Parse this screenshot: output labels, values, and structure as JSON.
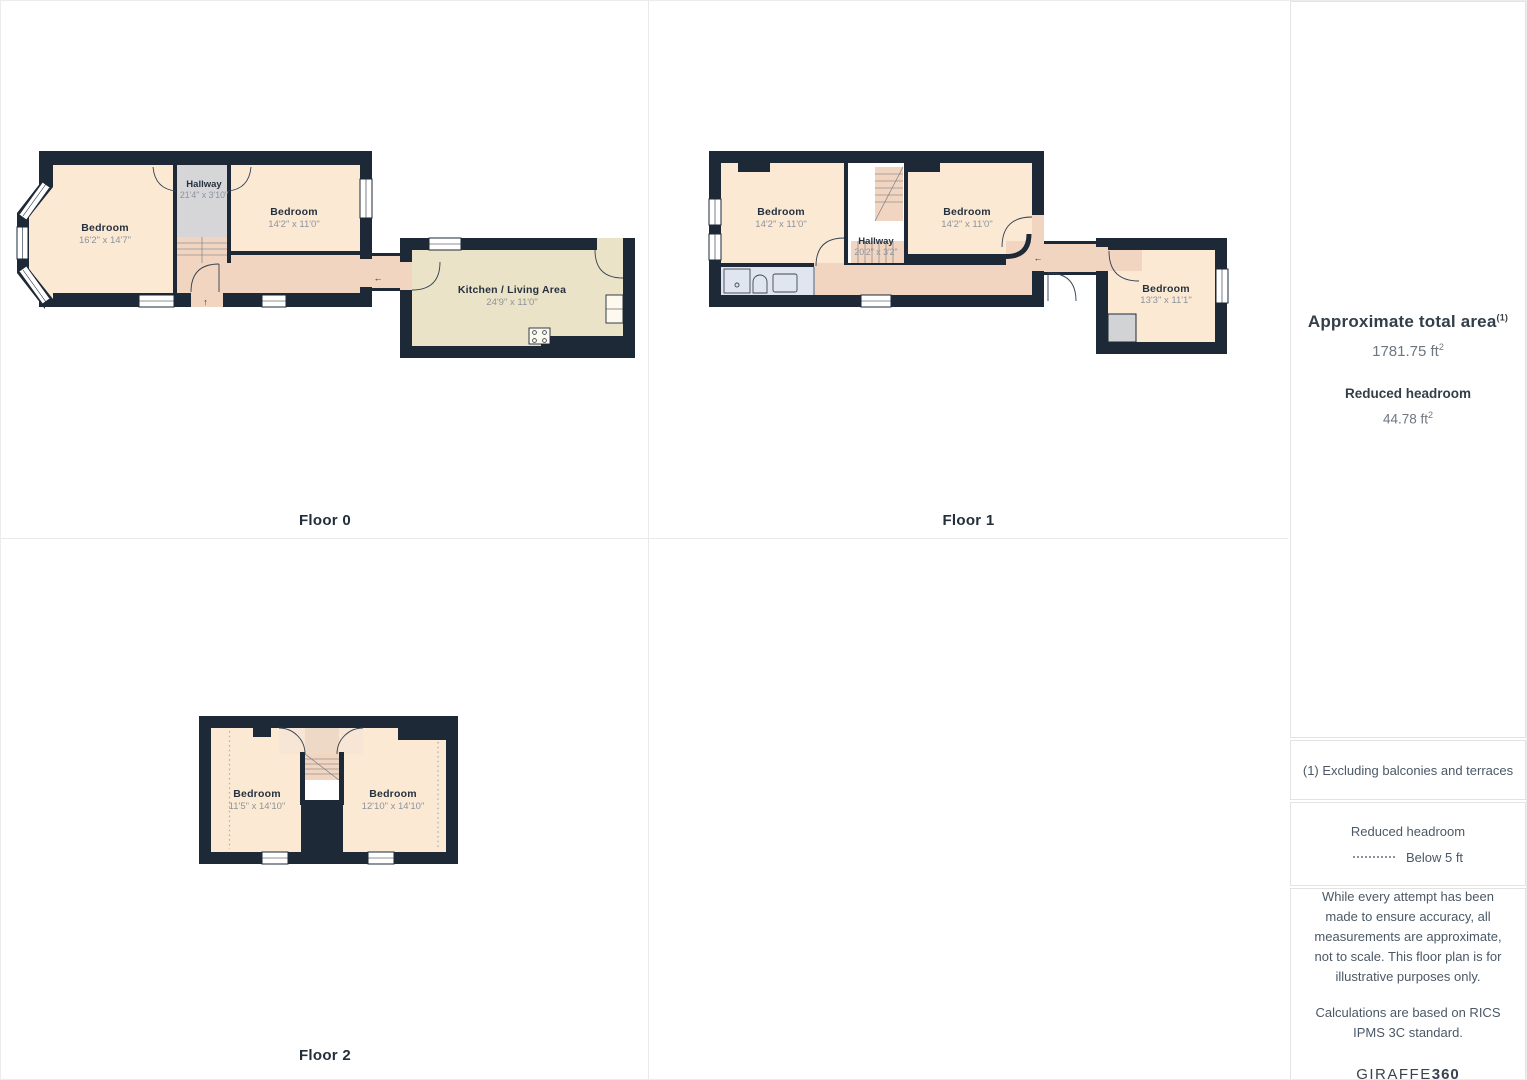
{
  "palette": {
    "wall": "#1d2937",
    "room": "#fbe9d3",
    "corridor": "#f1d5c1",
    "hallway": "#d6d6d8",
    "kitchen": "#ebe3c7",
    "bathroom": "#e0e5ef",
    "closet": "#d2d3d4",
    "grid_line": "#e9e9e9",
    "label": "#25313f",
    "dims": "#8d939c"
  },
  "symbols": {
    "arrow_up": "↑",
    "arrow_left": "←"
  },
  "floors": [
    {
      "label": "Floor 0",
      "rooms": [
        {
          "name": "Bedroom",
          "dims": "16'2\" x 14'7\""
        },
        {
          "name": "Hallway",
          "dims": "21'4\" x 3'10\""
        },
        {
          "name": "Bedroom",
          "dims": "14'2\" x 11'0\""
        },
        {
          "name": "Kitchen / Living Area",
          "dims": "24'9\" x 11'0\""
        }
      ]
    },
    {
      "label": "Floor 1",
      "rooms": [
        {
          "name": "Bedroom",
          "dims": "14'2\" x 11'0\""
        },
        {
          "name": "Hallway",
          "dims": "20'2\" x 3'2\""
        },
        {
          "name": "Bedroom",
          "dims": "14'2\" x 11'0\""
        },
        {
          "name": "Bedroom",
          "dims": "13'3\" x 11'1\""
        }
      ]
    },
    {
      "label": "Floor 2",
      "rooms": [
        {
          "name": "Bedroom",
          "dims": "11'5\" x 14'10\""
        },
        {
          "name": "Bedroom",
          "dims": "12'10\" x 14'10\""
        }
      ]
    }
  ],
  "sidebar": {
    "area_title": "Approximate total area",
    "area_title_sup": "(1)",
    "area_value": "1781.75 ft",
    "area_value_sup": "2",
    "headroom_title": "Reduced headroom",
    "headroom_value": "44.78 ft",
    "headroom_value_sup": "2",
    "note": "(1) Excluding balconies and terraces",
    "legend_title": "Reduced headroom",
    "legend_item": "Below 5 ft",
    "disclaimer_1": "While every attempt has been made to ensure accuracy, all measurements are approximate, not to scale. This floor plan is for illustrative purposes only.",
    "disclaimer_2": "Calculations are based on RICS IPMS 3C standard.",
    "brand_name": "GIRAFFE",
    "brand_suffix": "360"
  }
}
